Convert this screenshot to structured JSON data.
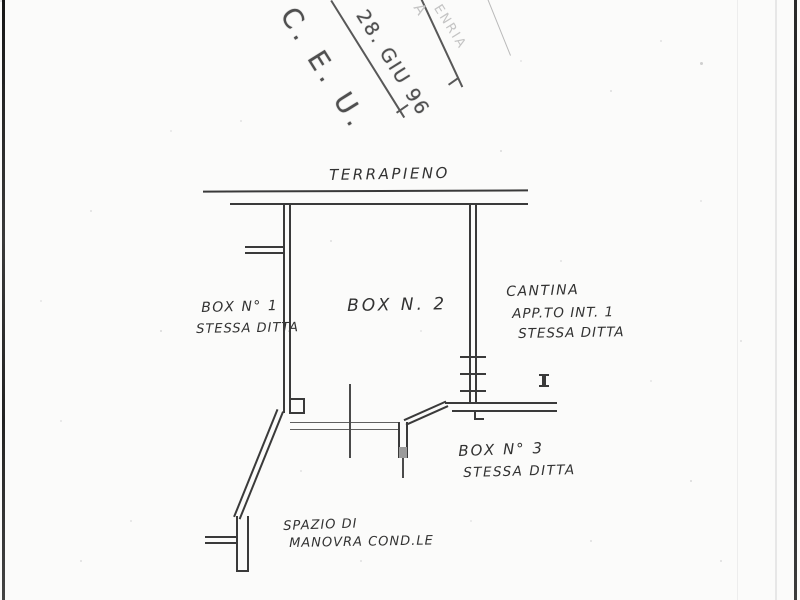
{
  "stamp": {
    "org": "C. E. U.",
    "date": "28. GIU 96",
    "faint_letter": "A",
    "faint_text": "ENRIA"
  },
  "plan": {
    "top_label": "TERRAPIENO",
    "box1": {
      "line1": "BOX N° 1",
      "line2": "STESSA DITTA"
    },
    "box2": {
      "line1": "BOX N. 2"
    },
    "cantina": {
      "line1": "CANTINA",
      "line2": "APP.TO INT. 1",
      "line3": "STESSA DITTA"
    },
    "box3": {
      "line1": "BOX N° 3",
      "line2": "STESSA DITTA"
    },
    "spazio": {
      "line1": "SPAZIO DI",
      "line2": "MANOVRA COND.LE"
    }
  },
  "colors": {
    "ink": "#3a3a3a",
    "stamp_ink": "#4f4f4f",
    "faint_ink": "#c4c4c4",
    "paper": "#fbfbfa"
  }
}
